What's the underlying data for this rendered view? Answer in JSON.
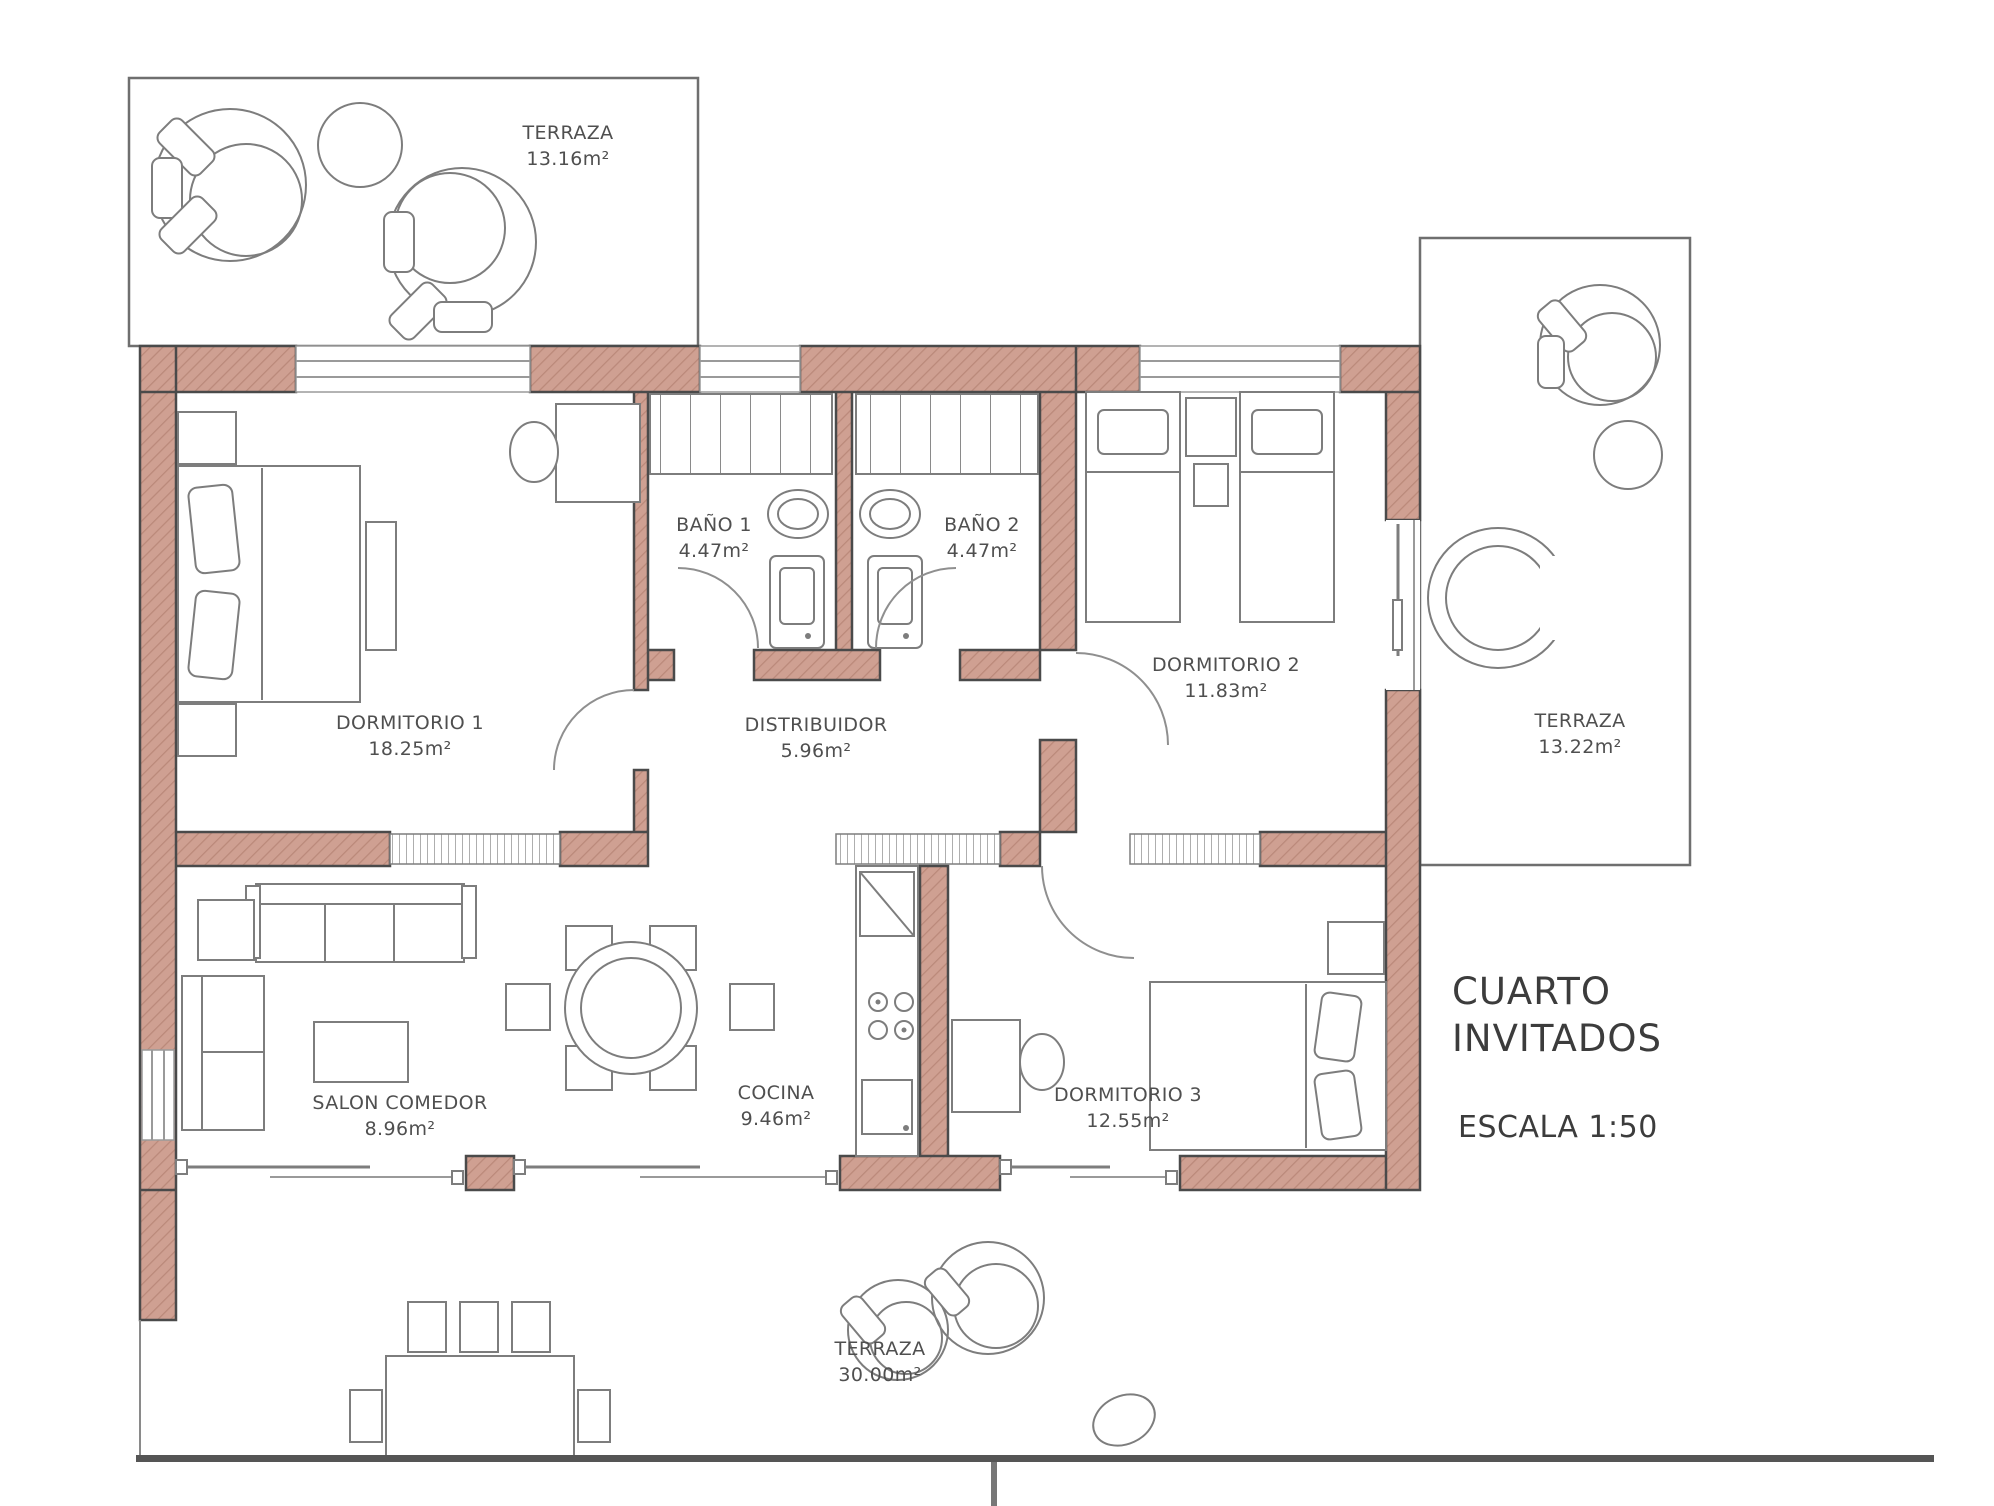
{
  "rooms": {
    "terraza_top": {
      "name": "TERRAZA",
      "area": "13.16m²"
    },
    "bano1": {
      "name": "BAÑO 1",
      "area": "4.47m²"
    },
    "bano2": {
      "name": "BAÑO 2",
      "area": "4.47m²"
    },
    "dormitorio1": {
      "name": "DORMITORIO 1",
      "area": "18.25m²"
    },
    "dormitorio2": {
      "name": "DORMITORIO 2",
      "area": "11.83m²"
    },
    "distribuidor": {
      "name": "DISTRIBUIDOR",
      "area": "5.96m²"
    },
    "terraza_right": {
      "name": "TERRAZA",
      "area": "13.22m²"
    },
    "salon": {
      "name": "SALON COMEDOR",
      "area": "8.96m²"
    },
    "cocina": {
      "name": "COCINA",
      "area": "9.46m²"
    },
    "dormitorio3": {
      "name": "DORMITORIO 3",
      "area": "12.55m²"
    },
    "terraza_bottom": {
      "name": "TERRAZA",
      "area": "30.00m²"
    }
  },
  "annotations": {
    "unit_line1": "CUARTO",
    "unit_line2": "INVITADOS",
    "scale": "ESCALA 1:50"
  },
  "colors": {
    "wall_fill": "#cfa092",
    "line_dark": "#4a4a4a",
    "furniture_line": "#7d7d7d",
    "text": "#4f4f4f"
  }
}
